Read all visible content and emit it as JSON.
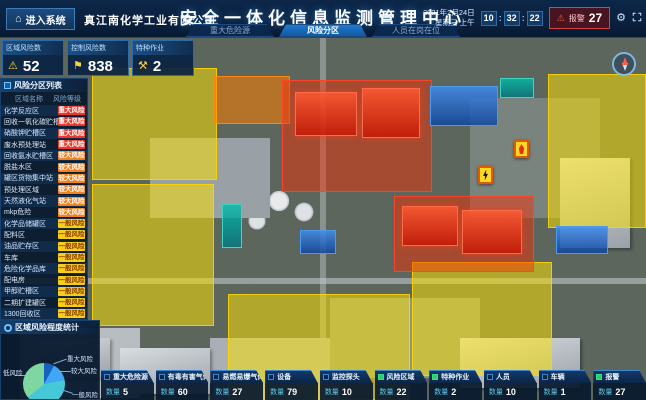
{
  "colors": {
    "accent": "#1e7ad0",
    "alarm": "#d04545",
    "risk_major": "#e8392b",
    "risk_large": "#f28220",
    "risk_general": "#f7cf1b",
    "zone_yellow": "#ffe200",
    "zone_red": "#ff2a00",
    "zone_blue": "#1565c0"
  },
  "icons": {
    "home": "⌂",
    "gear": "⚙",
    "warning_triangle": "⚠",
    "flag": "⚑",
    "work_tools": "⚒",
    "alarm_triangle": "⚠"
  },
  "header": {
    "enter_system": "进入系统",
    "company": "真江南化学工业有限公司",
    "title": "安全一体化信息监测管理中心",
    "tabs": [
      {
        "label": "重大危险源",
        "active": false
      },
      {
        "label": "风险分区",
        "active": true
      },
      {
        "label": "人员在岗在位",
        "active": false
      }
    ],
    "date_line1": "2021年2月24日",
    "date_line2": "星期三 上午",
    "time": {
      "h": "10",
      "m": "32",
      "s": "22"
    },
    "alarm_label": "报警",
    "alarm_count": "27"
  },
  "stats": [
    {
      "label": "区域风险数",
      "value": "52"
    },
    {
      "label": "控制风险数",
      "value": "838"
    },
    {
      "label": "特种作业",
      "value": "2"
    }
  ],
  "risk_list": {
    "title": "风险分区列表",
    "col_name": "区域名称",
    "col_level": "风险等级",
    "rows": [
      {
        "name": "化学反应区",
        "level": "重大风险",
        "level_type": "major"
      },
      {
        "name": "回收一氧化碳贮槽区",
        "level": "重大风险",
        "level_type": "major"
      },
      {
        "name": "硝酸钾贮槽区",
        "level": "重大风险",
        "level_type": "major"
      },
      {
        "name": "废水预处理站",
        "level": "重大风险",
        "level_type": "major"
      },
      {
        "name": "回收氨水贮槽区",
        "level": "较大风险",
        "level_type": "large"
      },
      {
        "name": "脱盐水区",
        "level": "较大风险",
        "level_type": "large"
      },
      {
        "name": "罐区货物集中站",
        "level": "较大风险",
        "level_type": "large"
      },
      {
        "name": "预处理区域",
        "level": "较大风险",
        "level_type": "large"
      },
      {
        "name": "天然液化气站",
        "level": "较大风险",
        "level_type": "large"
      },
      {
        "name": "mkp危险",
        "level": "较大风险",
        "level_type": "large"
      },
      {
        "name": "化学品储罐区",
        "level": "一般风险",
        "level_type": "general"
      },
      {
        "name": "配料区",
        "level": "一般风险",
        "level_type": "general"
      },
      {
        "name": "油品贮存区",
        "level": "一般风险",
        "level_type": "general"
      },
      {
        "name": "车库",
        "level": "一般风险",
        "level_type": "general"
      },
      {
        "name": "危险化学品库",
        "level": "一般风险",
        "level_type": "general"
      },
      {
        "name": "配电房",
        "level": "一般风险",
        "level_type": "general"
      },
      {
        "name": "甲醇贮槽区",
        "level": "一般风险",
        "level_type": "general"
      },
      {
        "name": "二期扩建罐区",
        "level": "一般风险",
        "level_type": "general"
      },
      {
        "name": "1300回收区",
        "level": "一般风险",
        "level_type": "general"
      },
      {
        "name": "罐区变电所",
        "level": "一般风险",
        "level_type": "general"
      }
    ]
  },
  "chart_data": {
    "type": "pie",
    "title": "区域风险程度统计",
    "labels": [
      "重大风险",
      "较大风险",
      "一般风险",
      "低风险"
    ],
    "values": [
      8,
      14,
      42,
      36
    ],
    "colors": [
      "#1660c0",
      "#3fa7f5",
      "#45c8d8",
      "#7ed6a0"
    ],
    "legend_position": "around-pie"
  },
  "bottom_bar": {
    "count_label": "数量",
    "items": [
      {
        "label": "重大危险源",
        "count": "5",
        "checked": false
      },
      {
        "label": "有毒有害气体",
        "count": "60",
        "checked": false
      },
      {
        "label": "易燃易爆气体",
        "count": "27",
        "checked": false
      },
      {
        "label": "设备",
        "count": "79",
        "checked": false
      },
      {
        "label": "监控探头",
        "count": "10",
        "checked": false
      },
      {
        "label": "风险区域",
        "count": "22",
        "checked": true
      },
      {
        "label": "特种作业",
        "count": "2",
        "checked": true
      },
      {
        "label": "人员",
        "count": "10",
        "checked": false
      },
      {
        "label": "车辆",
        "count": "1",
        "checked": false
      },
      {
        "label": "报警",
        "count": "27",
        "checked": true
      }
    ]
  },
  "map": {
    "markers": [
      {
        "type": "fire-warning"
      },
      {
        "type": "electric-warning"
      }
    ]
  }
}
